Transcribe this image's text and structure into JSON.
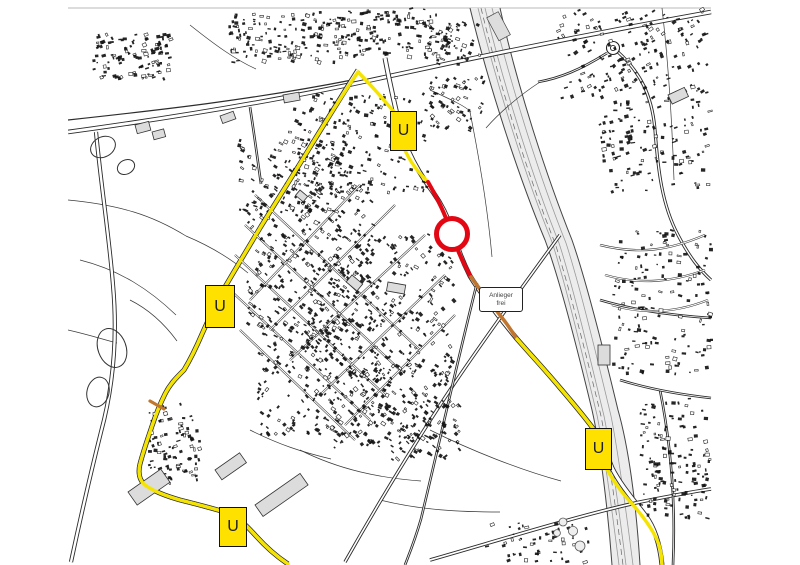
{
  "map": {
    "kind": "black-and-white city map with marked road closure and detour route",
    "detour_signs": [
      {
        "label": "U",
        "position": "top-center"
      },
      {
        "label": "U",
        "position": "mid-left"
      },
      {
        "label": "U",
        "position": "lower-right"
      },
      {
        "label": "U",
        "position": "bottom-center"
      }
    ],
    "closure_label": {
      "line1": "Anlieger",
      "line2": "frei"
    },
    "closure_marker": {
      "shape": "circle",
      "cx": 452,
      "cy": 234,
      "r": 15.5
    },
    "colors": {
      "detour_route": "#F5E400",
      "detour_sign_fill": "#FFE100",
      "closed_section": "#E30613",
      "residents_only_section": "#C0762F",
      "map_lines": "#1A1A1A",
      "background": "#FFFFFF"
    }
  }
}
